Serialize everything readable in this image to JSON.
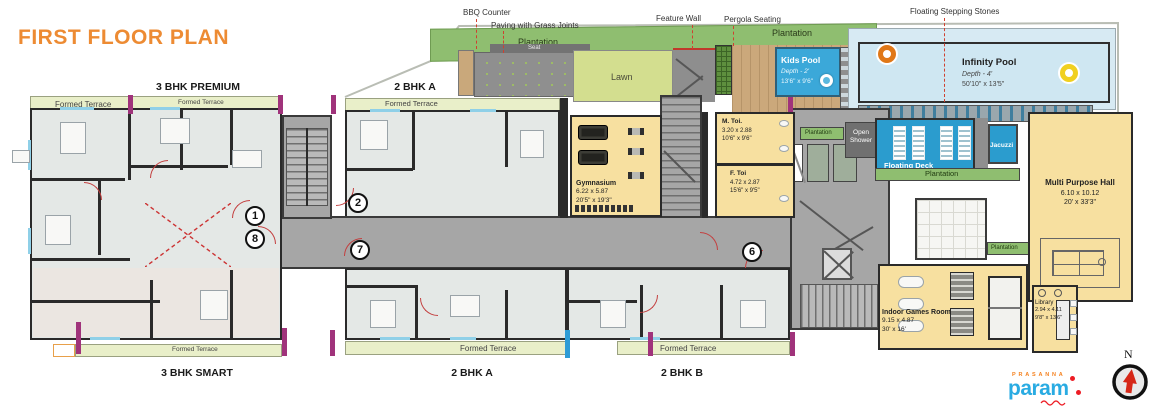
{
  "title": "FIRST FLOOR PLAN",
  "north_label": "N",
  "brand": {
    "prefix": "PRASANNA",
    "name": "param"
  },
  "callouts": {
    "bbq": "BBQ Counter",
    "paving": "Paving with Grass Joints",
    "feature_wall": "Feature Wall",
    "pergola": "Pergola Seating",
    "stepping_stones": "Floating Stepping Stones"
  },
  "labels": {
    "plantation": "Plantation",
    "seat": "Seat",
    "lawn": "Lawn",
    "formed_terrace": "Formed Terrace",
    "open_shower": "Open Shower",
    "floating_deck": "Floating Deck",
    "jacuzzi": "Jacuzzi"
  },
  "pools": {
    "kids": {
      "name": "Kids Pool",
      "depth": "Depth - 2'",
      "size": "13'6\" x 9'6\""
    },
    "infinity": {
      "name": "Infinity Pool",
      "depth": "Depth - 4'",
      "size": "50'10\" x 13'5\""
    }
  },
  "rooms": {
    "gym": {
      "name": "Gymnasium",
      "m": "6.22 x 5.87",
      "ft": "20'5\" x 19'3\""
    },
    "mtoi": {
      "name": "M. Toi.",
      "m": "3.20 x 2.88",
      "ft": "10'6\" x 9'6\""
    },
    "ftoi": {
      "name": "F. Toi",
      "m": "4.72 x 2.87",
      "ft": "15'6\" x 9'5\""
    },
    "mph": {
      "name": "Multi Purpose Hall",
      "m": "6.10 x 10.12",
      "ft": "20' x 33'3\""
    },
    "games": {
      "name": "Indoor Games Room",
      "m": "9.15 x 4.87",
      "ft": "30' x 16'"
    },
    "library": {
      "name": "Library",
      "m": "2.94 x 4.11",
      "ft": "9'8\" x 13'6\""
    }
  },
  "units": {
    "premium": "3 BHK PREMIUM",
    "a_top": "2 BHK A",
    "smart": "3 BHK SMART",
    "a_bottom": "2 BHK A",
    "b_bottom": "2 BHK B"
  },
  "markers": {
    "m1": "1",
    "m8": "8",
    "m2": "2",
    "m7": "7",
    "m6": "6"
  },
  "colors": {
    "title_orange": "#ED8B33",
    "plantation_green": "#8FBE70",
    "terrace_green": "#E9EFC9",
    "lawn_green": "#D3DE8F",
    "pool_blue": "#3BA8D9",
    "infinity_light": "#CFE7F2",
    "deck_blue": "#2B9CCE",
    "room_yellow": "#F7E0A0",
    "corridor_gray": "#A6A6A6",
    "wall_dark": "#2A2A2A",
    "magenta_accent": "#A0337B",
    "logo_blue": "#29ABE2",
    "logo_orange": "#F58220",
    "logo_red": "#ED1C24"
  }
}
